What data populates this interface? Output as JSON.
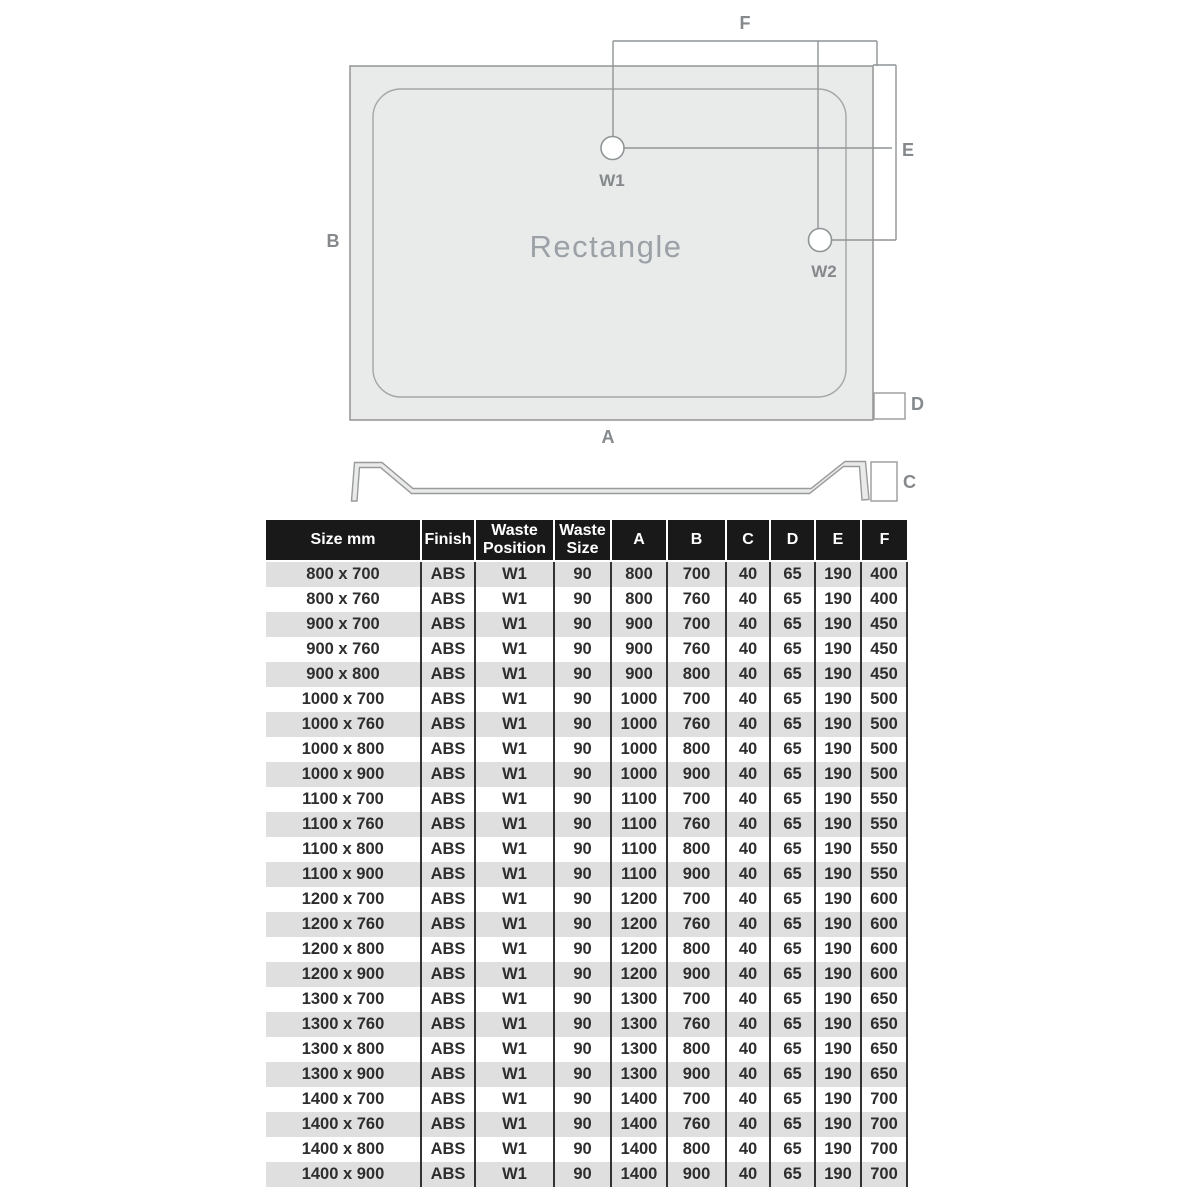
{
  "diagram": {
    "title": "Rectangle",
    "labels": {
      "a": "A",
      "b": "B",
      "c": "C",
      "d": "D",
      "e": "E",
      "f": "F"
    },
    "waste1": "W1",
    "waste2": "W2",
    "colors": {
      "tray_fill": "#e9eaea",
      "tray_outline": "#9a9a9a",
      "dimension_line": "#8f9496",
      "label_text": "#85898c",
      "title_text": "#9ba1a6"
    }
  },
  "table": {
    "columns": [
      "Size mm",
      "Finish",
      "Waste Position",
      "Waste Size",
      "A",
      "B",
      "C",
      "D",
      "E",
      "F"
    ],
    "rows": [
      [
        "800 x 700",
        "ABS",
        "W1",
        "90",
        "800",
        "700",
        "40",
        "65",
        "190",
        "400"
      ],
      [
        "800 x 760",
        "ABS",
        "W1",
        "90",
        "800",
        "760",
        "40",
        "65",
        "190",
        "400"
      ],
      [
        "900 x 700",
        "ABS",
        "W1",
        "90",
        "900",
        "700",
        "40",
        "65",
        "190",
        "450"
      ],
      [
        "900 x 760",
        "ABS",
        "W1",
        "90",
        "900",
        "760",
        "40",
        "65",
        "190",
        "450"
      ],
      [
        "900 x 800",
        "ABS",
        "W1",
        "90",
        "900",
        "800",
        "40",
        "65",
        "190",
        "450"
      ],
      [
        "1000 x 700",
        "ABS",
        "W1",
        "90",
        "1000",
        "700",
        "40",
        "65",
        "190",
        "500"
      ],
      [
        "1000 x 760",
        "ABS",
        "W1",
        "90",
        "1000",
        "760",
        "40",
        "65",
        "190",
        "500"
      ],
      [
        "1000 x 800",
        "ABS",
        "W1",
        "90",
        "1000",
        "800",
        "40",
        "65",
        "190",
        "500"
      ],
      [
        "1000 x 900",
        "ABS",
        "W1",
        "90",
        "1000",
        "900",
        "40",
        "65",
        "190",
        "500"
      ],
      [
        "1100 x 700",
        "ABS",
        "W1",
        "90",
        "1100",
        "700",
        "40",
        "65",
        "190",
        "550"
      ],
      [
        "1100 x 760",
        "ABS",
        "W1",
        "90",
        "1100",
        "760",
        "40",
        "65",
        "190",
        "550"
      ],
      [
        "1100 x 800",
        "ABS",
        "W1",
        "90",
        "1100",
        "800",
        "40",
        "65",
        "190",
        "550"
      ],
      [
        "1100 x 900",
        "ABS",
        "W1",
        "90",
        "1100",
        "900",
        "40",
        "65",
        "190",
        "550"
      ],
      [
        "1200 x 700",
        "ABS",
        "W1",
        "90",
        "1200",
        "700",
        "40",
        "65",
        "190",
        "600"
      ],
      [
        "1200 x 760",
        "ABS",
        "W1",
        "90",
        "1200",
        "760",
        "40",
        "65",
        "190",
        "600"
      ],
      [
        "1200 x 800",
        "ABS",
        "W1",
        "90",
        "1200",
        "800",
        "40",
        "65",
        "190",
        "600"
      ],
      [
        "1200 x 900",
        "ABS",
        "W1",
        "90",
        "1200",
        "900",
        "40",
        "65",
        "190",
        "600"
      ],
      [
        "1300 x 700",
        "ABS",
        "W1",
        "90",
        "1300",
        "700",
        "40",
        "65",
        "190",
        "650"
      ],
      [
        "1300 x 760",
        "ABS",
        "W1",
        "90",
        "1300",
        "760",
        "40",
        "65",
        "190",
        "650"
      ],
      [
        "1300 x 800",
        "ABS",
        "W1",
        "90",
        "1300",
        "800",
        "40",
        "65",
        "190",
        "650"
      ],
      [
        "1300 x 900",
        "ABS",
        "W1",
        "90",
        "1300",
        "900",
        "40",
        "65",
        "190",
        "650"
      ],
      [
        "1400 x 700",
        "ABS",
        "W1",
        "90",
        "1400",
        "700",
        "40",
        "65",
        "190",
        "700"
      ],
      [
        "1400 x 760",
        "ABS",
        "W1",
        "90",
        "1400",
        "760",
        "40",
        "65",
        "190",
        "700"
      ],
      [
        "1400 x 800",
        "ABS",
        "W1",
        "90",
        "1400",
        "800",
        "40",
        "65",
        "190",
        "700"
      ],
      [
        "1400 x 900",
        "ABS",
        "W1",
        "90",
        "1400",
        "900",
        "40",
        "65",
        "190",
        "700"
      ]
    ],
    "colors": {
      "header_bg": "#191919",
      "header_text": "#ffffff",
      "row_odd": "#dfdfdf",
      "row_even": "#ffffff",
      "grid_line": "#333333",
      "cell_text": "#2d2d2d"
    }
  }
}
